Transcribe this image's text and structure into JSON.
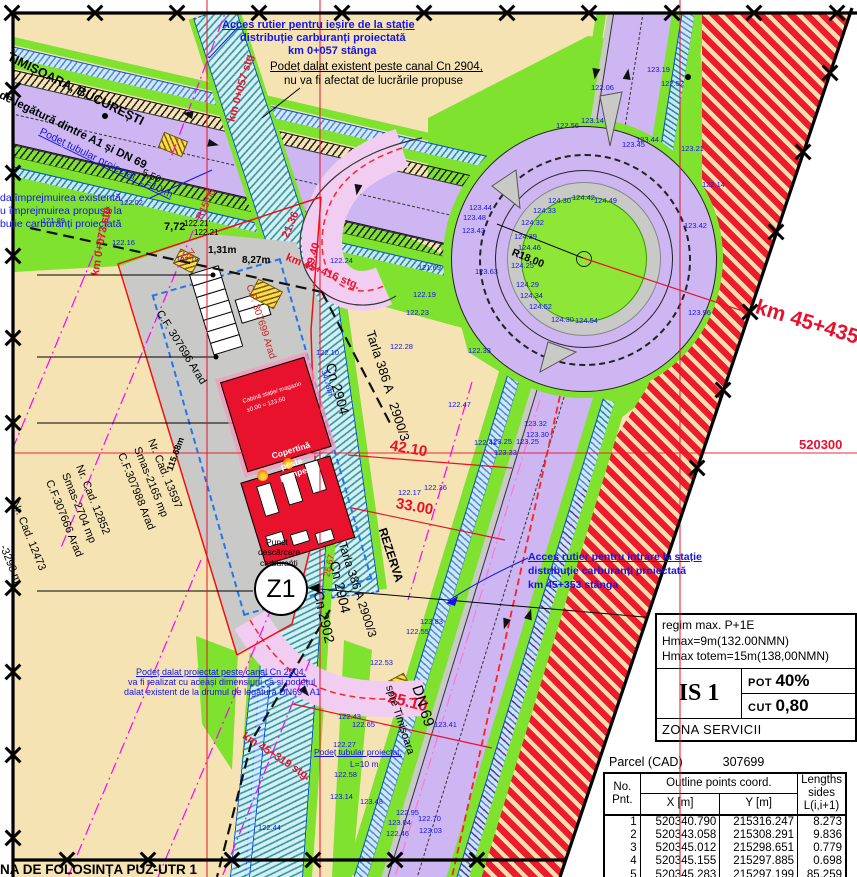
{
  "plan": {
    "zone_label": "Z1",
    "corner_text": "NA DE FOLOSINȚA PUZ-UTR 1",
    "coord_label": "520300"
  },
  "title_block": {
    "lines": [
      "regim max. P+1E",
      "Hmax=9m(132.00NMN)",
      "Hmax totem=15m(138,00NMN)"
    ],
    "zone_code": "IS 1",
    "pot_label": "POT",
    "pot_value": "40%",
    "cut_label": "CUT",
    "cut_value": "0,80",
    "zona": "ZONA SERVICII"
  },
  "parcel_table": {
    "title_label": "Parcel (CAD)",
    "parcel_number": "307699",
    "header_no1": "No.",
    "header_no2": "Pnt.",
    "header_group": "Outline points coord.",
    "header_x": "X [m]",
    "header_y": "Y [m]",
    "header_len1": "Lengths",
    "header_len2": "sides",
    "header_len3": "L(i,i+1)",
    "rows": [
      [
        "1",
        "520340.790",
        "215316.247",
        "8.273"
      ],
      [
        "2",
        "520343.058",
        "215308.291",
        "9.836"
      ],
      [
        "3",
        "520345.012",
        "215298.651",
        "0.779"
      ],
      [
        "4",
        "520345.155",
        "215297.885",
        "0.698"
      ],
      [
        "5",
        "520345.283",
        "215297.199",
        "85.259"
      ],
      [
        "6",
        "520304.894",
        "215285.197",
        "82.806"
      ]
    ]
  },
  "palette": {
    "tan": "#f6e3b4",
    "road_purple": "#cdb6f1",
    "grass_green": "#7fe22f",
    "canal_blue": "#0050d0",
    "red_zone": "#ec1c2e",
    "accent_red": "#e8112d",
    "annotation_blue": "#1414e6",
    "magenta": "#ff00ff",
    "site_gray": "#c9c9c7"
  },
  "labels": [
    {
      "t": "TIMIȘOARA, BUCUREȘTI",
      "x": 8,
      "y": 50,
      "r": 26,
      "s": 12.5,
      "c": "#000000",
      "b": 1
    },
    {
      "t": "l de legătură dintre A1 și DN 69",
      "x": -6,
      "y": 86,
      "r": 26,
      "s": 11.5,
      "c": "#000000",
      "b": 1
    },
    {
      "t": "Acces rutier pentru ieșire de la stație",
      "x": 222,
      "y": 20,
      "s": 11,
      "c": "#1414e6",
      "b": 1,
      "u": 1
    },
    {
      "t": "distribuție carburanți proiectată",
      "x": 240,
      "y": 33,
      "s": 11,
      "c": "#1414e6",
      "b": 1
    },
    {
      "t": "km 0+057 stânga",
      "x": 288,
      "y": 46,
      "s": 11,
      "c": "#1414e6",
      "b": 1
    },
    {
      "t": "Podeț dalat existent peste canal Cn 2904,",
      "x": 270,
      "y": 61,
      "s": 11.5,
      "c": "#000000",
      "u": 1
    },
    {
      "t": "nu va fi afectat de lucrările propuse",
      "x": 284,
      "y": 75,
      "s": 11.5,
      "c": "#000000"
    },
    {
      "t": "Podeț tubular proiectat, L=10 m",
      "x": 40,
      "y": 126,
      "r": 26,
      "s": 10.5,
      "c": "#1414e6",
      "u": 1
    },
    {
      "t": "da împrejmuirea existentă",
      "x": 0,
      "y": 193,
      "s": 10.5,
      "c": "#1414e6"
    },
    {
      "t": "u împrejmuirea propusă la",
      "x": 0,
      "y": 206,
      "s": 10.5,
      "c": "#1414e6"
    },
    {
      "t": "buție carburanți proiectată",
      "x": 0,
      "y": 219,
      "s": 10.5,
      "c": "#1414e6"
    },
    {
      "t": "km 0+057 stg",
      "x": 232,
      "y": 116,
      "r": -74,
      "s": 11,
      "c": "#e8112d",
      "b": 1
    },
    {
      "t": "km 0+073 stg",
      "x": 96,
      "y": 270,
      "r": -80,
      "s": 11,
      "c": "#e8112d",
      "b": 1
    },
    {
      "t": "km 45+416 stg.",
      "x": 286,
      "y": 252,
      "r": 22,
      "s": 11,
      "c": "#e8112d",
      "b": 1
    },
    {
      "t": "km 45+435",
      "x": 756,
      "y": 296,
      "r": 17,
      "s": 21,
      "c": "#e8112d",
      "b": 1
    },
    {
      "t": "520300",
      "x": 799,
      "y": 438,
      "s": 13,
      "c": "#e8112d",
      "b": 1
    },
    {
      "t": "km 45+319 stg.",
      "x": 243,
      "y": 730,
      "r": 33,
      "s": 11,
      "c": "#e8112d",
      "b": 1
    },
    {
      "t": "25.10",
      "x": 388,
      "y": 690,
      "r": 14,
      "s": 16,
      "c": "#e8112d",
      "b": 1
    },
    {
      "t": "42.10",
      "x": 390,
      "y": 438,
      "r": 10,
      "s": 15,
      "c": "#e8112d",
      "b": 1
    },
    {
      "t": "33.00",
      "x": 396,
      "y": 496,
      "r": 10,
      "s": 15,
      "c": "#e8112d",
      "b": 1
    },
    {
      "t": "39.40",
      "x": 310,
      "y": 264,
      "r": -74,
      "s": 11,
      "c": "#e8112d",
      "b": 1
    },
    {
      "t": "21.36",
      "x": 286,
      "y": 232,
      "r": -67,
      "s": 11,
      "c": "#e8112d",
      "b": 1
    },
    {
      "t": "26.67",
      "x": 327,
      "y": 572,
      "r": -77,
      "s": 9,
      "c": "#e8112d"
    },
    {
      "t": "R15.00",
      "x": 200,
      "y": 214,
      "r": -64,
      "s": 10,
      "c": "#e8112d"
    },
    {
      "t": "R18.00",
      "x": 512,
      "y": 247,
      "r": 22,
      "s": 10.5,
      "c": "#000000",
      "b": 1
    },
    {
      "t": "5,50",
      "x": 142,
      "y": 168,
      "r": 24,
      "s": 10,
      "c": "#000000"
    },
    {
      "t": "7,72",
      "x": 164,
      "y": 222,
      "s": 11,
      "c": "#000000",
      "b": 1
    },
    {
      "t": "122.21'",
      "x": 184,
      "y": 220,
      "s": 8,
      "c": "#000000"
    },
    {
      "t": "122.21",
      "x": 194,
      "y": 229,
      "s": 8,
      "c": "#000000"
    },
    {
      "t": "1,31m",
      "x": 208,
      "y": 246,
      "s": 10,
      "c": "#000000",
      "b": 1
    },
    {
      "t": "8,27m",
      "x": 242,
      "y": 256,
      "s": 10,
      "c": "#000000",
      "b": 1
    },
    {
      "t": "115.68m",
      "x": 170,
      "y": 466,
      "r": -70,
      "s": 9,
      "c": "#000000",
      "b": 1
    },
    {
      "t": "Nr. Cad. 13597",
      "x": 150,
      "y": 434,
      "r": 68,
      "s": 11,
      "c": "#000000"
    },
    {
      "t": "Smas-2165 mp",
      "x": 136,
      "y": 442,
      "r": 68,
      "s": 11,
      "c": "#000000"
    },
    {
      "t": "C.F.307988 Arad",
      "x": 120,
      "y": 448,
      "r": 68,
      "s": 11,
      "c": "#000000"
    },
    {
      "t": "Nr. Cad. 12852",
      "x": 78,
      "y": 460,
      "r": 68,
      "s": 11,
      "c": "#000000"
    },
    {
      "t": "Smas-2704 mp",
      "x": 64,
      "y": 468,
      "r": 68,
      "s": 11,
      "c": "#000000"
    },
    {
      "t": "C.F.307666 Arad",
      "x": 48,
      "y": 475,
      "r": 68,
      "s": 11,
      "c": "#000000"
    },
    {
      "t": "Nr. Cad. 12473",
      "x": 14,
      "y": 496,
      "r": 68,
      "s": 11,
      "c": "#000000"
    },
    {
      "t": "-3298 m",
      "x": 2,
      "y": 540,
      "r": 68,
      "s": 11,
      "c": "#000000"
    },
    {
      "t": "C.F. 307696 Arad",
      "x": 158,
      "y": 306,
      "r": 58,
      "s": 11,
      "c": "#000000"
    },
    {
      "t": "C.F. 307699 Arad",
      "x": 248,
      "y": 280,
      "r": 72,
      "s": 10,
      "c": "#cc2222"
    },
    {
      "t": "RV",
      "x": 189,
      "y": 255,
      "r": -60,
      "s": 8,
      "c": "#cc2222"
    },
    {
      "t": "Tarla 386 A",
      "x": 370,
      "y": 324,
      "r": 72,
      "s": 13,
      "c": "#000000"
    },
    {
      "t": "2900/3",
      "x": 393,
      "y": 396,
      "r": 72,
      "s": 13,
      "c": "#000000"
    },
    {
      "t": "Cn 2904",
      "x": 330,
      "y": 356,
      "r": 74,
      "s": 14,
      "c": "#000000"
    },
    {
      "t": "34.78m",
      "x": 323,
      "y": 366,
      "r": 74,
      "s": 8,
      "c": "#1414e6"
    },
    {
      "t": "Cn 2904",
      "x": 334,
      "y": 554,
      "r": 77,
      "s": 14,
      "c": "#000000"
    },
    {
      "t": "Cn 2902",
      "x": 318,
      "y": 584,
      "r": 77,
      "s": 14,
      "c": "#000000"
    },
    {
      "t": "Tarla 386 A 2900/3",
      "x": 342,
      "y": 536,
      "r": 72,
      "s": 12,
      "c": "#000000"
    },
    {
      "t": "REZERVA",
      "x": 382,
      "y": 522,
      "r": 72,
      "s": 12,
      "c": "#000000",
      "b": 1
    },
    {
      "t": "DN 69",
      "x": 416,
      "y": 678,
      "r": 72,
      "s": 15,
      "c": "#000000"
    },
    {
      "t": "spre Timișoara",
      "x": 388,
      "y": 680,
      "r": 72,
      "s": 11,
      "c": "#000000"
    },
    {
      "t": "Punct",
      "x": 266,
      "y": 538,
      "s": 8.5,
      "c": "#000000"
    },
    {
      "t": "descărcare",
      "x": 258,
      "y": 548,
      "s": 8.5,
      "c": "#000000"
    },
    {
      "t": "carburanți",
      "x": 260,
      "y": 559,
      "s": 8.5,
      "c": "#000000"
    },
    {
      "t": "Copertină",
      "x": 272,
      "y": 452,
      "r": -17,
      "s": 8.5,
      "c": "#ffffff",
      "b": 1
    },
    {
      "t": "peste",
      "x": 281,
      "y": 463,
      "r": -17,
      "s": 8.5,
      "c": "#ffffff",
      "b": 1
    },
    {
      "t": "pompe",
      "x": 280,
      "y": 474,
      "r": -17,
      "s": 8.5,
      "c": "#ffffff",
      "b": 1
    },
    {
      "t": "Cabină stație/ magazin",
      "x": 243,
      "y": 399,
      "r": -17,
      "s": 6,
      "c": "#ffffff"
    },
    {
      "t": "±0.00 = 123.60",
      "x": 247,
      "y": 408,
      "r": -17,
      "s": 6,
      "c": "#ffffff"
    },
    {
      "t": "Podeț dalat proiectat peste canal Cn 2904,",
      "x": 136,
      "y": 668,
      "s": 9,
      "c": "#1414e6",
      "u": 1
    },
    {
      "t": "va fi realizat cu aceași dimensiuni ca și podețul",
      "x": 128,
      "y": 678,
      "s": 9,
      "c": "#1414e6"
    },
    {
      "t": "dalat existent de la drumul de legătură DN69 - A1",
      "x": 124,
      "y": 688,
      "s": 9,
      "c": "#1414e6"
    },
    {
      "t": "Acces rutier pentru intrare la stație",
      "x": 528,
      "y": 552,
      "s": 10.5,
      "c": "#1414e6",
      "b": 1,
      "u": 1
    },
    {
      "t": "distribuție carburanți proiectată",
      "x": 528,
      "y": 566,
      "s": 10.5,
      "c": "#1414e6",
      "b": 1
    },
    {
      "t": "km 45+353 stânga",
      "x": 528,
      "y": 580,
      "s": 10.5,
      "c": "#1414e6",
      "b": 1
    },
    {
      "t": "Podeț tubular proiectat,",
      "x": 314,
      "y": 748,
      "s": 8.5,
      "c": "#1414e6",
      "u": 1
    },
    {
      "t": "L=10 m",
      "x": 350,
      "y": 760,
      "s": 8.5,
      "c": "#1414e6"
    },
    {
      "t": "NA DE FOLOSINȚA PUZ-UTR 1",
      "x": 0,
      "y": 863,
      "s": 13.5,
      "c": "#000000",
      "b": 1
    }
  ],
  "elevations": [
    [
      42,
      216,
      "121.89"
    ],
    [
      120,
      198,
      "122.02"
    ],
    [
      112,
      238,
      "122.16"
    ],
    [
      176,
      255,
      "122.18"
    ],
    [
      330,
      256,
      "122.24"
    ],
    [
      418,
      263,
      "121.69"
    ],
    [
      413,
      290,
      "122.19"
    ],
    [
      406,
      308,
      "122.23"
    ],
    [
      390,
      342,
      "122.28"
    ],
    [
      316,
      348,
      "122.10"
    ],
    [
      398,
      488,
      "122.17"
    ],
    [
      424,
      483,
      "122.36"
    ],
    [
      448,
      400,
      "122.47"
    ],
    [
      338,
      712,
      "122.43"
    ],
    [
      352,
      720,
      "122.65"
    ],
    [
      333,
      740,
      "122.27"
    ],
    [
      334,
      770,
      "122.58"
    ],
    [
      330,
      792,
      "123.14"
    ],
    [
      360,
      797,
      "123.48"
    ],
    [
      258,
      823,
      "122.44"
    ],
    [
      418,
      814,
      "122.70"
    ],
    [
      419,
      826,
      "123.03"
    ],
    [
      396,
      808,
      "122.95"
    ],
    [
      388,
      818,
      "123.04"
    ],
    [
      386,
      829,
      "122.46"
    ],
    [
      434,
      720,
      "123.41"
    ],
    [
      474,
      438,
      "122.41"
    ],
    [
      524,
      419,
      "123.32"
    ],
    [
      526,
      430,
      "123.30"
    ],
    [
      489,
      437,
      "123.25"
    ],
    [
      516,
      437,
      "123.25"
    ],
    [
      494,
      448,
      "123.33"
    ],
    [
      420,
      617,
      "123.83"
    ],
    [
      406,
      627,
      "122.55"
    ],
    [
      370,
      658,
      "122.53"
    ],
    [
      548,
      196,
      "124.30"
    ],
    [
      572,
      193,
      "124.42"
    ],
    [
      594,
      196,
      "124.49"
    ],
    [
      533,
      206,
      "124.33"
    ],
    [
      521,
      218,
      "124.32"
    ],
    [
      514,
      232,
      "124.39"
    ],
    [
      518,
      243,
      "124.46"
    ],
    [
      511,
      261,
      "124.25"
    ],
    [
      516,
      280,
      "124.29"
    ],
    [
      520,
      291,
      "124.34"
    ],
    [
      529,
      302,
      "124.52"
    ],
    [
      551,
      315,
      "124.30"
    ],
    [
      575,
      316,
      "124.54"
    ],
    [
      469,
      203,
      "123.44"
    ],
    [
      463,
      213,
      "123.48"
    ],
    [
      462,
      226,
      "123.43"
    ],
    [
      475,
      267,
      "123.63"
    ],
    [
      468,
      346,
      "122.33"
    ],
    [
      556,
      121,
      "122.56"
    ],
    [
      581,
      116,
      "123.14"
    ],
    [
      622,
      140,
      "123.45"
    ],
    [
      636,
      135,
      "123.44"
    ],
    [
      591,
      83,
      "122.06"
    ],
    [
      661,
      79,
      "122.52"
    ],
    [
      647,
      65,
      "123.19"
    ],
    [
      681,
      144,
      "123.21"
    ],
    [
      684,
      221,
      "123.42"
    ],
    [
      688,
      308,
      "123.96"
    ],
    [
      702,
      180,
      "122.14"
    ]
  ],
  "xmarks": [
    [
      12,
      13
    ],
    [
      95,
      13
    ],
    [
      177,
      13
    ],
    [
      259,
      13
    ],
    [
      342,
      13
    ],
    [
      424,
      13
    ],
    [
      507,
      13
    ],
    [
      589,
      13
    ],
    [
      672,
      13
    ],
    [
      754,
      13
    ],
    [
      837,
      13
    ],
    [
      13,
      90
    ],
    [
      13,
      173
    ],
    [
      13,
      256
    ],
    [
      13,
      338
    ],
    [
      13,
      423
    ],
    [
      13,
      505
    ],
    [
      13,
      588
    ],
    [
      13,
      672
    ],
    [
      13,
      755
    ],
    [
      13,
      838
    ],
    [
      67,
      860
    ],
    [
      148,
      860
    ],
    [
      232,
      860
    ],
    [
      313,
      860
    ],
    [
      395,
      860
    ],
    [
      477,
      860
    ],
    [
      830,
      73
    ],
    [
      803,
      152
    ],
    [
      776,
      232
    ],
    [
      750,
      312
    ],
    [
      723,
      390
    ],
    [
      697,
      468
    ]
  ],
  "arrows": [
    {
      "x": 182,
      "y": 110,
      "r": 193
    },
    {
      "x": 208,
      "y": 140,
      "r": 13
    },
    {
      "x": 500,
      "y": 620,
      "r": 107
    },
    {
      "x": 524,
      "y": 610,
      "r": 287
    },
    {
      "x": 352,
      "y": 186,
      "r": 100
    },
    {
      "x": 300,
      "y": 688,
      "r": 50
    },
    {
      "x": 622,
      "y": 70,
      "r": 279
    },
    {
      "x": 590,
      "y": 70,
      "r": 99
    }
  ]
}
